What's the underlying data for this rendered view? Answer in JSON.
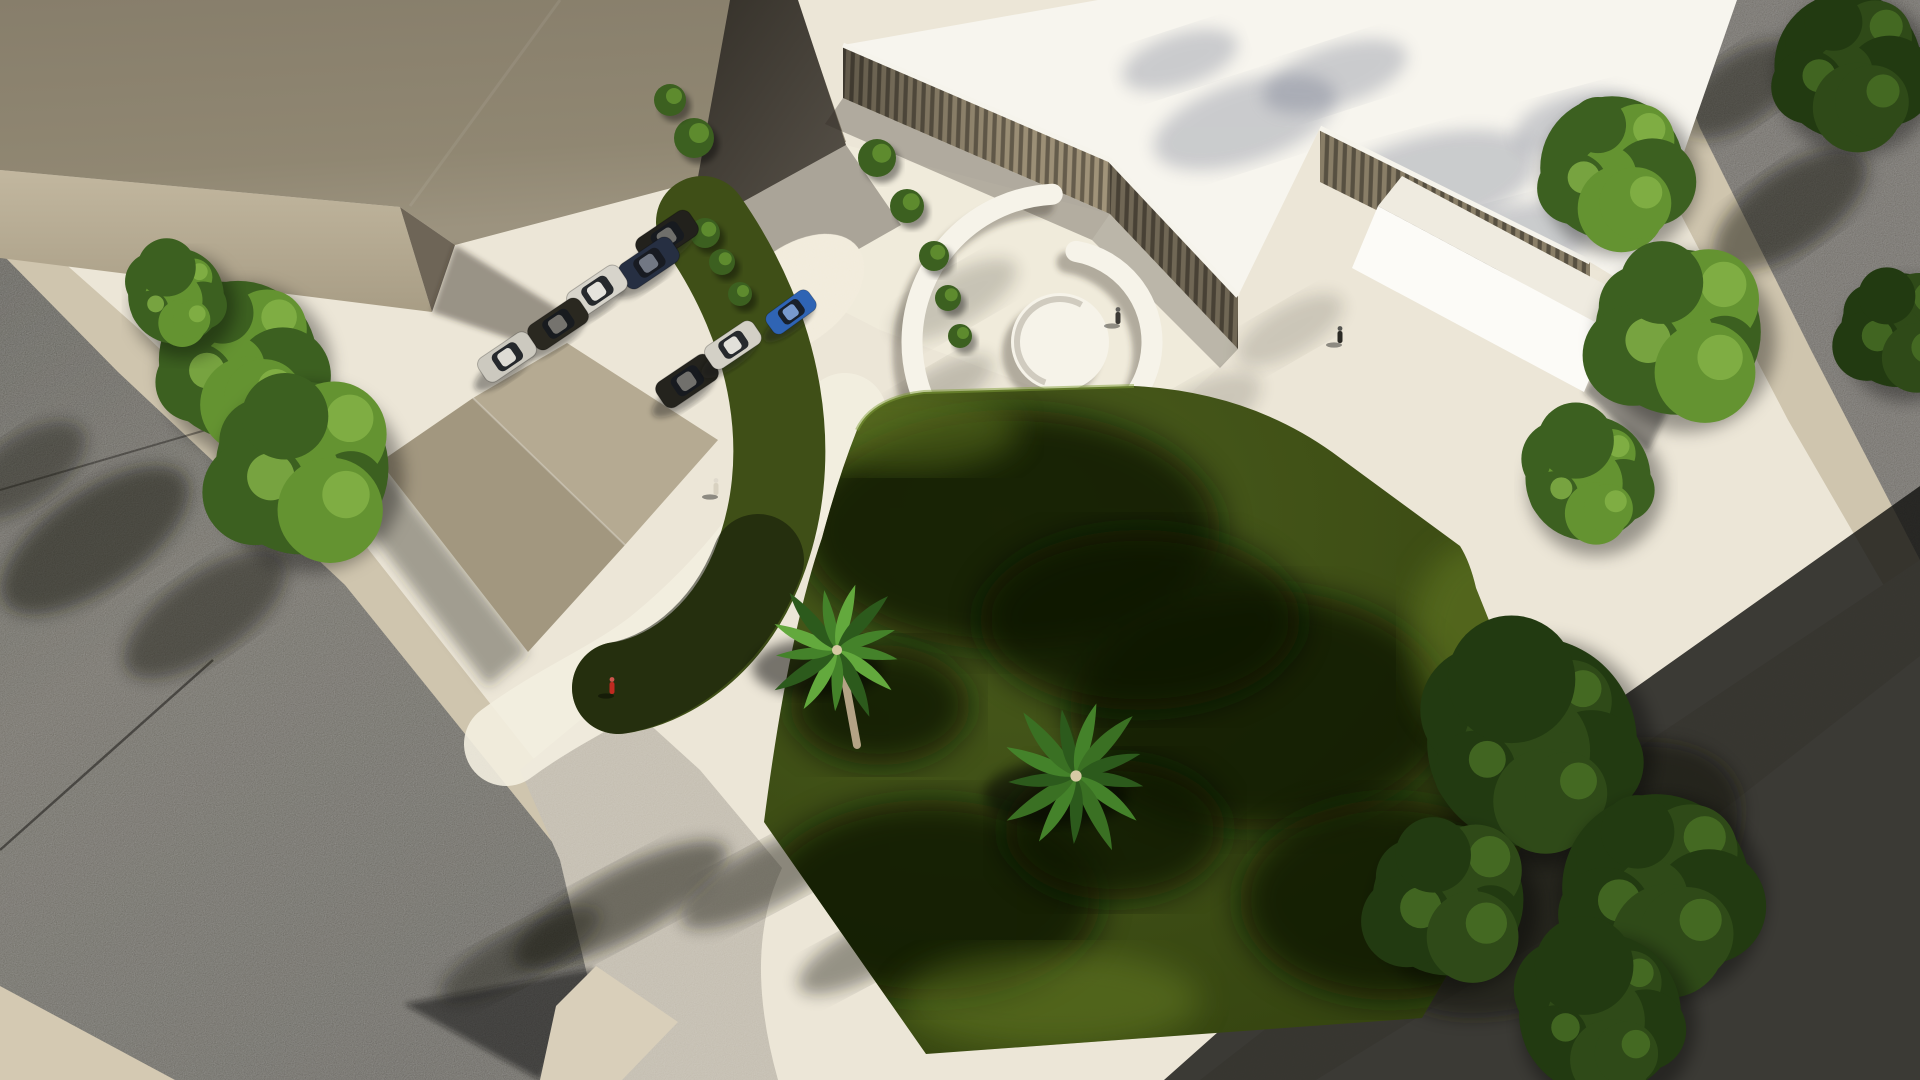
{
  "scene": {
    "description": "Aerial 3D architectural rendering: modern slatted-facade building with white roof, circular plaza benches, parking lot with cars, lawns with palm trees, streets with tree shadows",
    "canvas": {
      "width": 1920,
      "height": 1080
    },
    "palette": {
      "base": "#ece6d7",
      "roadMid": "#585449",
      "sidewalk": "#cfc5ae",
      "apron": "#bdb6a7",
      "bigRoofTop": "#8d8471",
      "bigRoofBottom": "#9a917d",
      "bigWallLight": "#c0b59d",
      "bigWallDark": "#a99e86",
      "darkWall": "#3a362e",
      "slatBar": "#a1947a",
      "slatGap": "#675e4d",
      "whiteRoof": "#f7f5ee",
      "fascia": "#f6f4ec",
      "annexFace": "#fcfbf7",
      "lawn": "#3f4f17",
      "lawnShadow": "#101806",
      "lawnLight": "#6d8526",
      "treeSunMid": "#3c6020",
      "treeSunLight": "#649331",
      "treeSunHi": "#86b449",
      "treeShadeBase": "#223a11",
      "treeShadeMid": "#2f4a18",
      "treeShadeHi": "#4a7026",
      "palmMid": "#44822a",
      "palmDark": "#2c5a1c",
      "palmLight": "#63a93d",
      "trunk": "#b4a385",
      "glass": "#171a1f",
      "carShadow": "rgba(30,27,22,0.4)",
      "blueCar": "#2f64b4",
      "redPerson": "#c02a20"
    },
    "plaza": {
      "cx": 1060,
      "cy": 342,
      "disc_r": 49,
      "inner_r": 92,
      "outer_r": 148,
      "inner_start": -80,
      "inner_end": 85,
      "outer_start": 95,
      "outer_end": 267,
      "bench_w": 21,
      "bench_color": "#f6f3e9",
      "shadow_color": "rgba(60,54,44,0.35)"
    },
    "cars": [
      {
        "x": 667,
        "y": 237,
        "angle": -34,
        "color": "#22211c",
        "len": 64
      },
      {
        "x": 649,
        "y": 263,
        "angle": -34,
        "color": "#262f42",
        "len": 62
      },
      {
        "x": 597,
        "y": 291,
        "angle": -34,
        "color": "#d7d4cb",
        "len": 62
      },
      {
        "x": 558,
        "y": 324,
        "angle": -34,
        "color": "#2a2820",
        "len": 62
      },
      {
        "x": 507,
        "y": 357,
        "angle": -34,
        "color": "#ccc9bf",
        "len": 60
      },
      {
        "x": 687,
        "y": 381,
        "angle": -34,
        "color": "#24231d",
        "len": 64
      },
      {
        "x": 733,
        "y": 345,
        "angle": -34,
        "color": "#d3d0c6",
        "len": 58
      },
      {
        "x": 791,
        "y": 312,
        "angle": -36,
        "color": "#2f64b4",
        "len": 52
      }
    ],
    "palms": [
      {
        "x": 837,
        "y": 650,
        "r": 72,
        "tone": "light",
        "trunk": true
      },
      {
        "x": 1076,
        "y": 776,
        "r": 80,
        "tone": "dark",
        "trunk": false
      }
    ],
    "trees": [
      {
        "cx": 238,
        "cy": 360,
        "r": 86,
        "variant": "sun",
        "branches": false
      },
      {
        "cx": 302,
        "cy": 468,
        "r": 94,
        "variant": "sun",
        "branches": false
      },
      {
        "cx": 176,
        "cy": 296,
        "r": 52,
        "variant": "sun",
        "branches": false
      },
      {
        "cx": 1612,
        "cy": 168,
        "r": 78,
        "variant": "sun",
        "branches": false
      },
      {
        "cx": 1678,
        "cy": 332,
        "r": 90,
        "variant": "sun",
        "branches": false
      },
      {
        "cx": 1588,
        "cy": 478,
        "r": 68,
        "variant": "sun",
        "branches": false
      },
      {
        "cx": 1848,
        "cy": 66,
        "r": 80,
        "variant": "shade",
        "branches": false
      },
      {
        "cx": 1898,
        "cy": 330,
        "r": 62,
        "variant": "shade",
        "branches": false
      },
      {
        "cx": 1532,
        "cy": 742,
        "r": 114,
        "variant": "shade",
        "branches": true
      },
      {
        "cx": 1656,
        "cy": 888,
        "r": 102,
        "variant": "shade",
        "branches": true
      },
      {
        "cx": 1448,
        "cy": 900,
        "r": 82,
        "variant": "shade",
        "branches": false
      },
      {
        "cx": 1600,
        "cy": 1014,
        "r": 88,
        "variant": "shade",
        "branches": false
      }
    ],
    "bushes": [
      [
        705,
        233,
        15
      ],
      [
        722,
        262,
        13
      ],
      [
        740,
        294,
        12
      ],
      [
        877,
        158,
        19
      ],
      [
        907,
        206,
        17
      ],
      [
        934,
        256,
        15
      ],
      [
        948,
        298,
        13
      ],
      [
        694,
        138,
        20
      ],
      [
        670,
        100,
        16
      ],
      [
        960,
        336,
        12
      ]
    ],
    "people": [
      {
        "x": 1118,
        "y": 318,
        "color": "#3b3934"
      },
      {
        "x": 1340,
        "y": 337,
        "color": "#2b2a25"
      },
      {
        "x": 612,
        "y": 688,
        "color": "#c02a20"
      },
      {
        "x": 716,
        "y": 489,
        "color": "#d8d1c0"
      }
    ],
    "ground_shadows": [
      [
        95,
        540,
        110,
        48,
        -35,
        0.5
      ],
      [
        205,
        615,
        95,
        40,
        -35,
        0.45
      ],
      [
        25,
        470,
        70,
        34,
        -35,
        0.4
      ],
      [
        620,
        905,
        120,
        34,
        -28,
        0.5
      ],
      [
        770,
        875,
        100,
        30,
        -28,
        0.45
      ],
      [
        520,
        955,
        90,
        26,
        -28,
        0.4
      ],
      [
        870,
        950,
        80,
        26,
        -28,
        0.4
      ],
      [
        1790,
        210,
        90,
        40,
        -35,
        0.5
      ],
      [
        1740,
        90,
        70,
        34,
        -35,
        0.45
      ],
      [
        1560,
        880,
        200,
        110,
        -30,
        0.55
      ],
      [
        955,
        300,
        70,
        26,
        -30,
        0.18
      ],
      [
        1190,
        420,
        80,
        30,
        -30,
        0.15
      ],
      [
        1290,
        330,
        60,
        24,
        -30,
        0.15
      ],
      [
        940,
        390,
        60,
        22,
        -30,
        0.2
      ]
    ],
    "roof_shadows": [
      [
        1245,
        122,
        95,
        40,
        -18
      ],
      [
        1425,
        185,
        115,
        48,
        -15
      ],
      [
        1335,
        76,
        75,
        30,
        -18
      ],
      [
        1508,
        245,
        85,
        38,
        -15
      ],
      [
        1575,
        122,
        62,
        28,
        -15
      ],
      [
        1180,
        60,
        60,
        26,
        -18
      ],
      [
        1520,
        320,
        80,
        44,
        -15
      ]
    ],
    "lawn_shadows": [
      [
        1010,
        530,
        210,
        120
      ],
      [
        1260,
        710,
        190,
        120
      ],
      [
        930,
        900,
        170,
        100
      ],
      [
        1390,
        900,
        150,
        100
      ],
      [
        1140,
        620,
        160,
        90
      ],
      [
        880,
        705,
        90,
        60
      ],
      [
        1115,
        830,
        110,
        70
      ]
    ],
    "lawn_lights": [
      [
        900,
        430,
        120,
        40
      ],
      [
        1050,
        1000,
        150,
        50
      ],
      [
        1480,
        640,
        70,
        100
      ]
    ]
  }
}
